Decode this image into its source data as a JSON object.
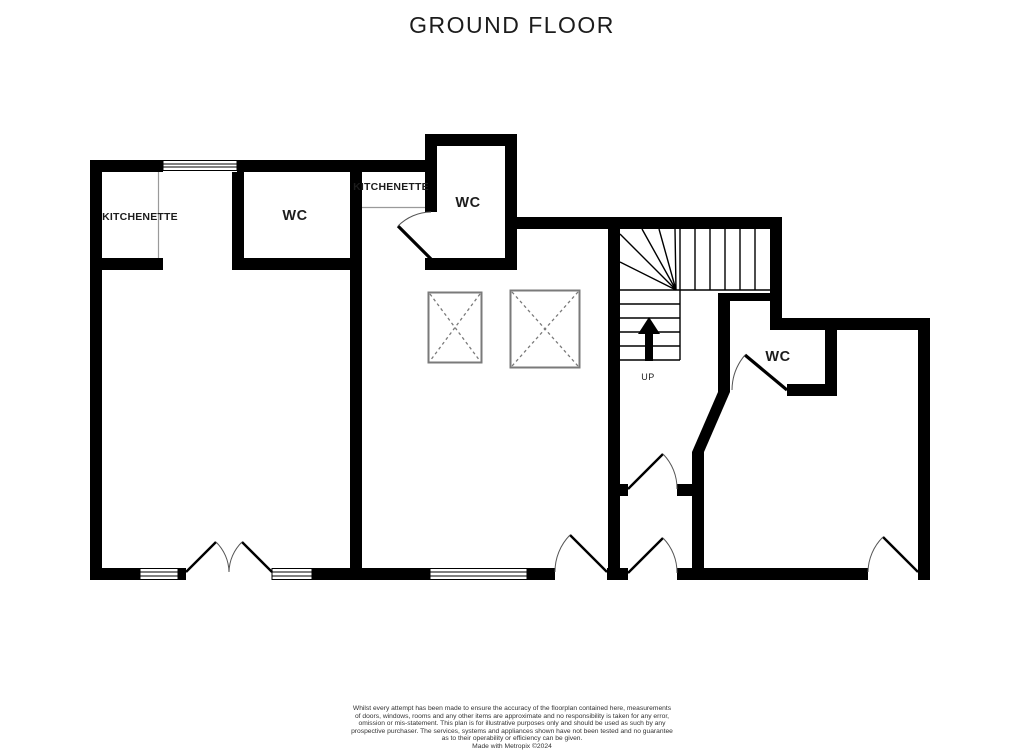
{
  "title": "GROUND FLOOR",
  "rooms": {
    "kitchenette_left": {
      "label": "KITCHENETTE"
    },
    "wc_left": {
      "label": "WC"
    },
    "kitchenette_middle": {
      "label": "KITCHENETTE"
    },
    "wc_middle": {
      "label": "WC"
    },
    "wc_right": {
      "label": "WC"
    },
    "stairs": {
      "label": "UP"
    }
  },
  "disclaimer": {
    "lines": [
      "Whilst every attempt has been made to ensure the accuracy of the floorplan contained here, measurements",
      "of doors, windows, rooms and any other items are approximate and no responsibility is taken for any error,",
      "omission or mis-statement. This plan is for illustrative purposes only and should be used as such by any",
      "prospective purchaser. The services, systems and appliances shown have not been tested and no guarantee",
      "as to their operability or efficiency can be given.",
      "Made with Metropix ©2024"
    ]
  },
  "colors": {
    "wall": "#000000",
    "background": "#ffffff",
    "door_arc": "#555555",
    "door_leaf": "#000000",
    "rooflight": "#7a7a7a",
    "partition": "#9a9a9a",
    "text": "#1c1c1c"
  }
}
